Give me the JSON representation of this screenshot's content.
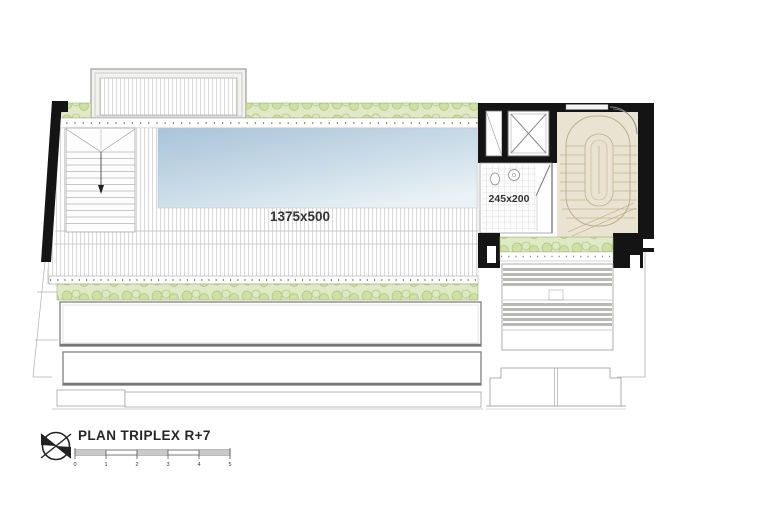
{
  "plan": {
    "title": "PLAN TRIPLEX R+7",
    "labels": {
      "pool": "1375x500",
      "bathroom": "245x200"
    },
    "scale_bar": {
      "ticks": [
        "0",
        "1",
        "2",
        "3",
        "4",
        "5"
      ]
    },
    "colors": {
      "wall_black": "#141414",
      "pool_dark": "#a9c3da",
      "pool_light": "#eaf2f6",
      "vegetation_bg": "#e0e9c6",
      "vegetation_plant": "#cfe0a4",
      "stair_room_floor": "#eae3d1",
      "stair_line": "#bfae8a",
      "louver_slat": "#b8b8b4",
      "deck_line": "#d8d8d8"
    },
    "icons": {
      "north_arrow": "north-arrow-icon"
    }
  }
}
